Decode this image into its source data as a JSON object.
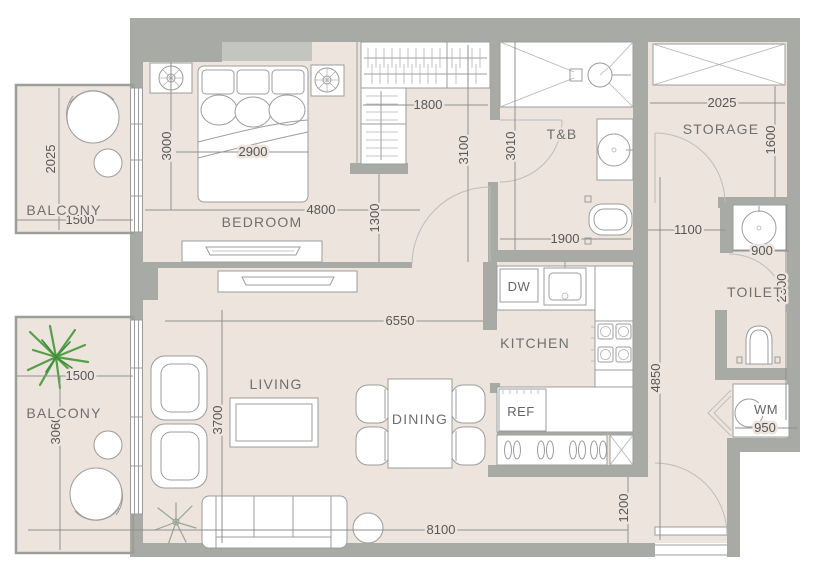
{
  "rooms": {
    "balcony_top": {
      "label": "BALCONY"
    },
    "bedroom": {
      "label": "BEDROOM"
    },
    "tb": {
      "label": "T&B"
    },
    "storage": {
      "label": "STORAGE"
    },
    "toilet": {
      "label": "TOILET"
    },
    "kitchen": {
      "label": "KITCHEN"
    },
    "living": {
      "label": "LIVING"
    },
    "dining": {
      "label": "DINING"
    },
    "balcony_bottom": {
      "label": "BALCONY"
    }
  },
  "appliances": {
    "dishwasher": "DW",
    "refrigerator": "REF",
    "washing_machine": "WM"
  },
  "dims": {
    "balcony_top_depth": "2025",
    "balcony_top_width": "1500",
    "bedroom_depth": "3000",
    "bed_width": "2900",
    "bedroom_length": "4800",
    "bedroom_door": "1300",
    "closet_width": "1800",
    "closet_depth": "3100",
    "tb_depth": "3010",
    "tb_width": "1900",
    "storage_width": "2025",
    "storage_depth": "1600",
    "hall_width": "1100",
    "toilet_sink": "900",
    "toilet_depth": "2300",
    "living_width": "6550",
    "living_depth": "3700",
    "balcony_bottom_width": "1500",
    "balcony_bottom_depth": "3060",
    "hallway_length": "4850",
    "wm_width": "950",
    "unit_width": "8100",
    "entry_width": "1200"
  },
  "colors": {
    "wall_gray": "#a8aba5",
    "floor_beige": "#ece4dd",
    "fixture_white": "#ffffff",
    "outline_gray": "#9c9c9c",
    "dim_text": "#575757",
    "label_text": "#6f6f6f",
    "plant_green": "#54a047"
  }
}
